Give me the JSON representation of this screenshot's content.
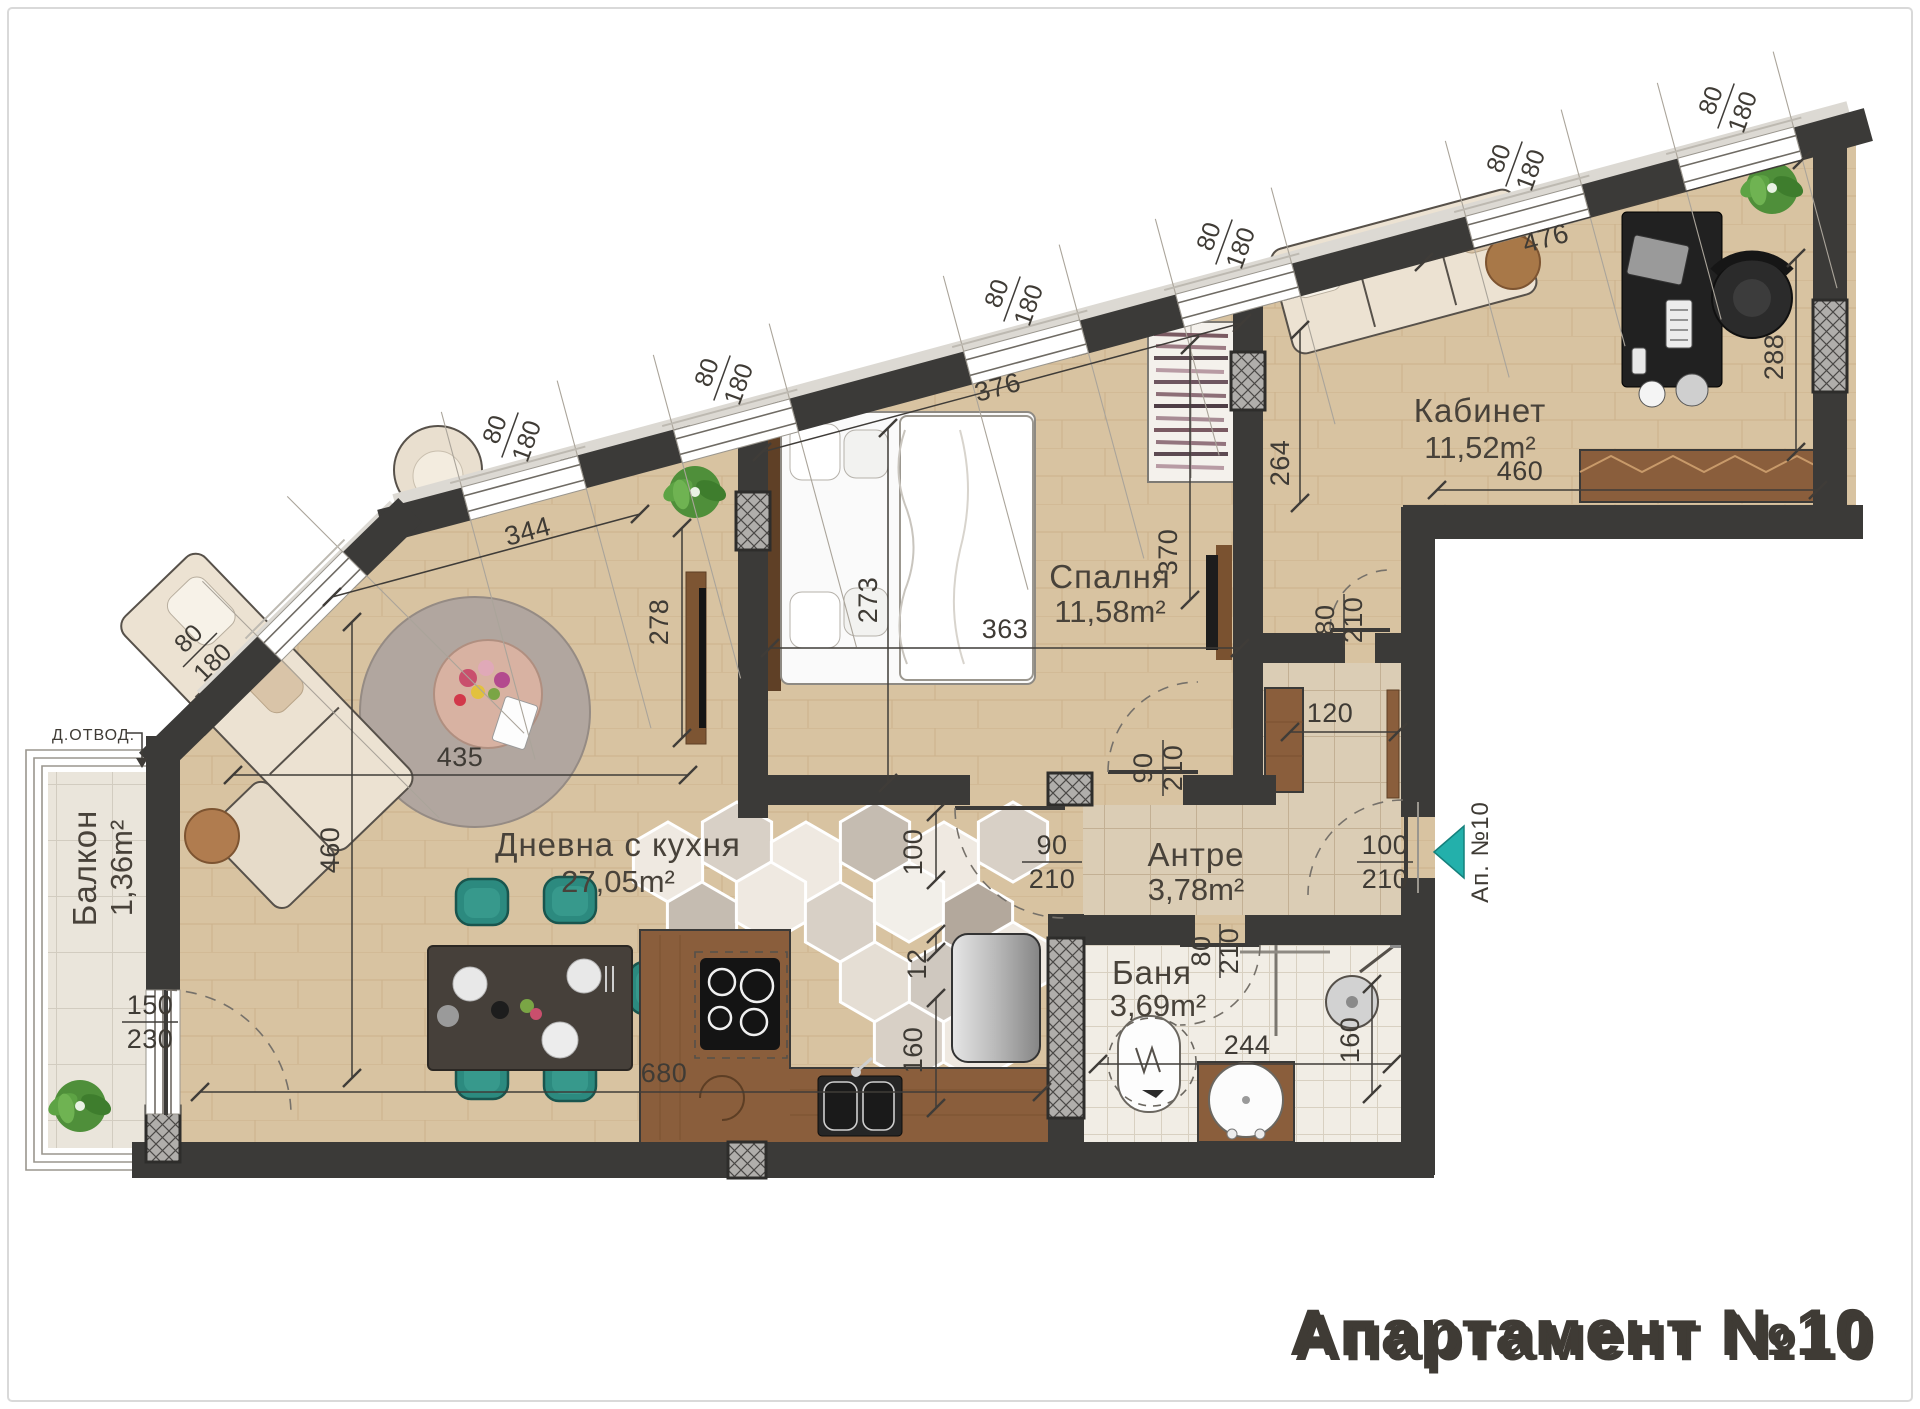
{
  "title": "Апартамент №10",
  "rooms": {
    "office": {
      "name": "Кабинет",
      "area": "11,52m²"
    },
    "bedroom": {
      "name": "Спалня",
      "area": "11,58m²"
    },
    "living": {
      "name": "Дневна с кухня",
      "area": "27,05m²"
    },
    "hall": {
      "name": "Антре",
      "area": "3,78m²"
    },
    "bath": {
      "name": "Баня",
      "area": "3,69m²"
    },
    "balcony": {
      "name": "Балкон",
      "area": "1,36m²"
    }
  },
  "entrance": {
    "label": "Ап. №10"
  },
  "drain_label": "Д.ОТВОД.",
  "dims": {
    "win": {
      "a": "80",
      "b": "180"
    },
    "balcony_door": {
      "a": "150",
      "b": "230"
    },
    "bedroom_top": "376",
    "bed_width": "273",
    "bed_length": "363",
    "living_wall": "278",
    "living_top": "344",
    "rug": "435",
    "living_left": "460",
    "kitchen_bottom": "680",
    "office_top": "476",
    "office_right": "288",
    "office_bottom": "460",
    "nook": "264",
    "bedroom_right": "370",
    "closet": "120",
    "pass": "100",
    "gap": "12",
    "kitchen_wall": "160",
    "bath_width": "244",
    "bath_right": "160",
    "bedroom_door": {
      "a": "90",
      "b": "210"
    },
    "living_door": {
      "a": "90",
      "b": "210"
    },
    "office_door": {
      "a": "80",
      "b": "210"
    },
    "bath_door": {
      "a": "80",
      "b": "210"
    },
    "entrance_door": {
      "a": "100",
      "b": "210"
    }
  },
  "colors": {
    "wall": "#3b3a38",
    "accent": "#23b0ab",
    "wood": "#d8c3a1",
    "title_gray": "#c0c0c0"
  }
}
